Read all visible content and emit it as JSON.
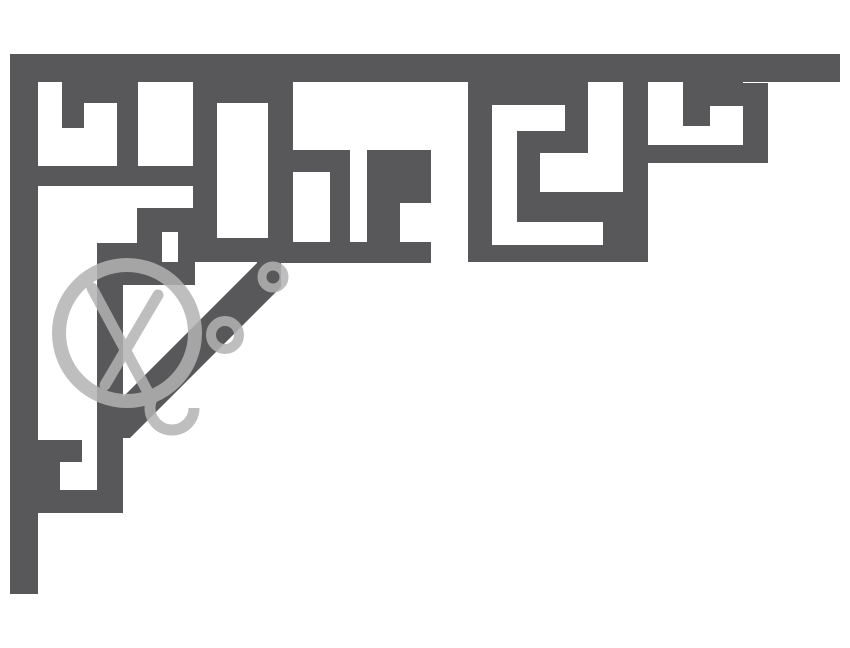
{
  "artwork": {
    "title": "Decorative greek-key corner bracket fretwork with faint circular watermark",
    "canvas": {
      "width": 850,
      "height": 648
    },
    "colors": {
      "background": "#ffffff",
      "bracket": "#58585a",
      "watermark": "#b3b3b3"
    },
    "rects": [
      {
        "name": "top-rail",
        "x": 10,
        "y": 54,
        "w": 830,
        "h": 28,
        "fill": "bracket"
      },
      {
        "name": "left-rail",
        "x": 10,
        "y": 54,
        "w": 28,
        "h": 540,
        "fill": "bracket"
      },
      {
        "name": "pillar-u1",
        "x": 62,
        "y": 82,
        "w": 22,
        "h": 46,
        "fill": "bracket"
      },
      {
        "name": "lintel-u1-right",
        "x": 84,
        "y": 82,
        "w": 33,
        "h": 21,
        "fill": "bracket"
      },
      {
        "name": "separator-u1-u2",
        "x": 117,
        "y": 82,
        "w": 21,
        "h": 85,
        "fill": "bracket"
      },
      {
        "name": "band-left",
        "x": 10,
        "y": 166,
        "w": 207,
        "h": 20,
        "fill": "bracket"
      },
      {
        "name": "slot3-left-wall",
        "x": 193,
        "y": 82,
        "w": 24,
        "h": 180,
        "fill": "bracket"
      },
      {
        "name": "lintel-slot3",
        "x": 217,
        "y": 82,
        "w": 51,
        "h": 21,
        "fill": "bracket"
      },
      {
        "name": "slot3-right-wall",
        "x": 268,
        "y": 82,
        "w": 25,
        "h": 180,
        "fill": "bracket"
      },
      {
        "name": "slot3-bottom-block",
        "x": 193,
        "y": 238,
        "w": 100,
        "h": 24,
        "fill": "bracket"
      },
      {
        "name": "window-top-stroke",
        "x": 268,
        "y": 150,
        "w": 82,
        "h": 22,
        "fill": "bracket"
      },
      {
        "name": "window-right-stroke",
        "x": 330,
        "y": 150,
        "w": 20,
        "h": 113,
        "fill": "bracket"
      },
      {
        "name": "band-middle",
        "x": 257,
        "y": 242,
        "w": 174,
        "h": 21,
        "fill": "bracket"
      },
      {
        "name": "pendant-top",
        "x": 367,
        "y": 150,
        "w": 64,
        "h": 53,
        "fill": "bracket"
      },
      {
        "name": "pendant-left-leg",
        "x": 367,
        "y": 203,
        "w": 33,
        "h": 40,
        "fill": "bracket"
      },
      {
        "name": "spiral-left-wall",
        "x": 468,
        "y": 82,
        "w": 24,
        "h": 180,
        "fill": "bracket"
      },
      {
        "name": "lintel-spiral",
        "x": 492,
        "y": 82,
        "w": 73,
        "h": 23,
        "fill": "bracket"
      },
      {
        "name": "spiral-stroke-down",
        "x": 565,
        "y": 82,
        "w": 23,
        "h": 71,
        "fill": "bracket"
      },
      {
        "name": "spiral-stroke-left",
        "x": 517,
        "y": 131,
        "w": 71,
        "h": 22,
        "fill": "bracket"
      },
      {
        "name": "spiral-stroke-inner",
        "x": 517,
        "y": 131,
        "w": 23,
        "h": 82,
        "fill": "bracket"
      },
      {
        "name": "spiral-stroke-base",
        "x": 517,
        "y": 192,
        "w": 106,
        "h": 30,
        "fill": "bracket"
      },
      {
        "name": "spiral-stub",
        "x": 603,
        "y": 222,
        "w": 20,
        "h": 23,
        "fill": "bracket"
      },
      {
        "name": "spiral-bottom-wall",
        "x": 492,
        "y": 245,
        "w": 156,
        "h": 17,
        "fill": "bracket"
      },
      {
        "name": "spiral-right-wall",
        "x": 623,
        "y": 82,
        "w": 25,
        "h": 180,
        "fill": "bracket"
      },
      {
        "name": "lintel-r2",
        "x": 683,
        "y": 82,
        "w": 60,
        "h": 24,
        "fill": "bracket"
      },
      {
        "name": "pillar-r1",
        "x": 683,
        "y": 106,
        "w": 27,
        "h": 20,
        "fill": "bracket"
      },
      {
        "name": "band-right",
        "x": 648,
        "y": 145,
        "w": 120,
        "h": 18,
        "fill": "bracket"
      },
      {
        "name": "pillar-right-end",
        "x": 743,
        "y": 83,
        "w": 25,
        "h": 62,
        "fill": "bracket"
      },
      {
        "name": "hook-outer",
        "x": 137,
        "y": 208,
        "w": 58,
        "h": 77,
        "fill": "bracket"
      },
      {
        "name": "hook-notch",
        "x": 162,
        "y": 232,
        "w": 16,
        "h": 30,
        "fill": "background"
      },
      {
        "name": "hook-connector",
        "x": 97,
        "y": 243,
        "w": 40,
        "h": 42,
        "fill": "bracket"
      },
      {
        "name": "inner-drop-bar",
        "x": 97,
        "y": 243,
        "w": 26,
        "h": 270,
        "fill": "bracket"
      },
      {
        "name": "foot-bottom-bar",
        "x": 38,
        "y": 490,
        "w": 85,
        "h": 23,
        "fill": "bracket"
      },
      {
        "name": "foot-arm",
        "x": 38,
        "y": 440,
        "w": 44,
        "h": 22,
        "fill": "bracket"
      },
      {
        "name": "foot-stub",
        "x": 38,
        "y": 462,
        "w": 22,
        "h": 28,
        "fill": "bracket"
      }
    ],
    "polygons": [
      {
        "name": "diagonal-strut",
        "points": "257,263 281,263 281,287 130,438 106,438 106,414",
        "fill": "bracket"
      }
    ],
    "watermark": {
      "opacity": 0.85,
      "circles": [
        {
          "name": "watermark-ring",
          "cx": 127,
          "cy": 333,
          "r": 68,
          "sw": 14,
          "dash": ""
        },
        {
          "name": "watermark-small-ring",
          "cx": 273,
          "cy": 277,
          "r": 11,
          "sw": 9,
          "dash": ""
        },
        {
          "name": "watermark-letter-o",
          "cx": 225,
          "cy": 335,
          "r": 14,
          "sw": 10,
          "dash": ""
        },
        {
          "name": "watermark-arc-fragment",
          "cx": 172,
          "cy": 408,
          "r": 22,
          "sw": 11,
          "dash": "86 52"
        }
      ],
      "lines": [
        {
          "name": "watermark-chord-1",
          "x1": 92,
          "y1": 288,
          "x2": 150,
          "y2": 396,
          "sw": 11
        },
        {
          "name": "watermark-chord-2",
          "x1": 158,
          "y1": 295,
          "x2": 105,
          "y2": 385,
          "sw": 11
        }
      ]
    }
  }
}
